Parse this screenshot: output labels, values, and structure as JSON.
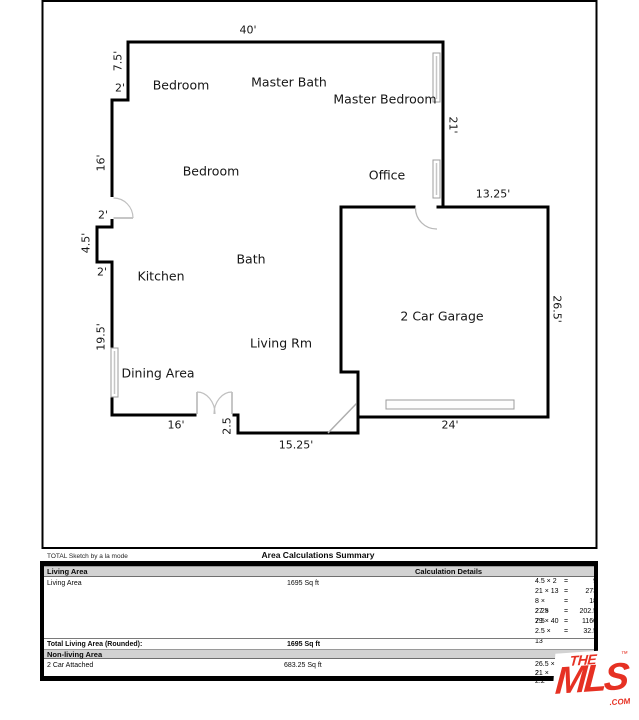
{
  "floorplan": {
    "rooms": {
      "bedroom_top": "Bedroom",
      "master_bath": "Master Bath",
      "master_bedroom": "Master Bedroom",
      "bedroom_mid": "Bedroom",
      "office": "Office",
      "kitchen": "Kitchen",
      "bath": "Bath",
      "living": "Living Rm",
      "dining": "Dining Area",
      "garage": "2 Car Garage"
    },
    "dimensions": {
      "top_40": "40'",
      "left_7_5": "7.5'",
      "left_2_upper": "2'",
      "left_16": "16'",
      "left_2_door": "2'",
      "left_4_5": "4.5'",
      "left_2_lower": "2'",
      "left_19_5": "19.5'",
      "bottom_16": "16'",
      "bottom_2_5": "2.5",
      "bottom_15_25": "15.25'",
      "garage_24": "24'",
      "right_21": "21'",
      "garage_13_25": "13.25'",
      "garage_26_5": "26.5'"
    }
  },
  "summary_table": {
    "credit": "TOTAL Sketch by a la mode",
    "title": "Area Calculations Summary",
    "living_header": "Living Area",
    "calc_header": "Calculation Details",
    "living_row": {
      "label": "Living Area",
      "value": "1695 Sq ft"
    },
    "living_calcs": [
      {
        "expr": "4.5 × 2",
        "eq": "=",
        "val": "9"
      },
      {
        "expr": "21 × 13",
        "eq": "=",
        "val": "273"
      },
      {
        "expr": "8 × 2.25",
        "eq": "=",
        "val": "18"
      },
      {
        "expr": "27 × 7.5",
        "eq": "=",
        "val": "202.5"
      },
      {
        "expr": "29 × 40",
        "eq": "=",
        "val": "1160"
      },
      {
        "expr": "2.5 × 13",
        "eq": "=",
        "val": "32.5"
      }
    ],
    "total_row": {
      "label": "Total Living Area (Rounded):",
      "value": "1695 Sq ft"
    },
    "nonliving_header": "Non-living Area",
    "garage_row": {
      "label": "2 Car Attached",
      "value": "683.25 Sq ft"
    },
    "garage_calcs": [
      {
        "expr": "26.5 × 2"
      },
      {
        "expr": "21 × 2.2"
      }
    ]
  },
  "logo": {
    "the": "THE",
    "mls": "MLS",
    "com": ".COM",
    "tm": "™",
    "red": "#e63123"
  }
}
